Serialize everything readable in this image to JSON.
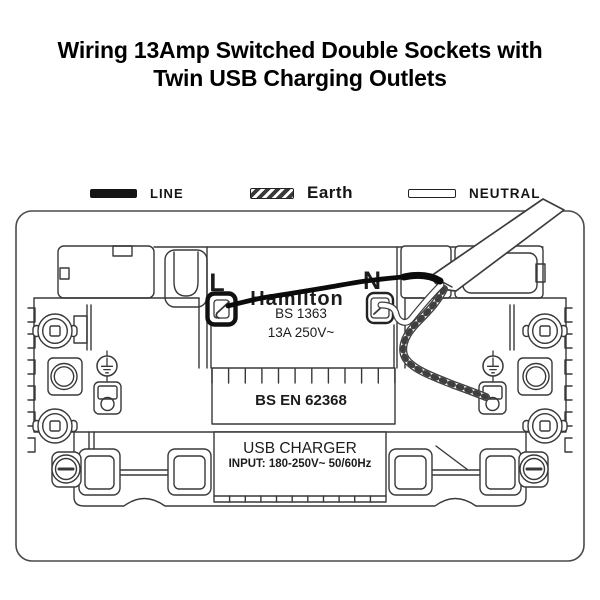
{
  "title": {
    "line1": "Wiring 13Amp Switched Double Sockets with",
    "line2": "Twin USB Charging Outlets"
  },
  "legend": {
    "items": [
      {
        "label": "LINE",
        "swatch": "solid-black"
      },
      {
        "label": "Earth",
        "swatch": "hatched"
      },
      {
        "label": "NEUTRAL",
        "swatch": "outline-white"
      }
    ]
  },
  "diagram": {
    "terminal_labels": {
      "live": "L",
      "neutral": "N"
    },
    "markings": {
      "brand": "Hamilton",
      "socket_standard": "BS 1363",
      "rating": "13A 250V~",
      "usb_standard": "BS EN 62368"
    },
    "usb_module": {
      "name": "USB CHARGER",
      "input_rating": "INPUT: 180-250V~ 50/60Hz"
    },
    "icons": {
      "earth_symbol": "ground/earth (IEC 5017)"
    },
    "colors": {
      "line_wire": "#0b0b0b",
      "outline": "#383838",
      "background": "#ffffff"
    }
  }
}
